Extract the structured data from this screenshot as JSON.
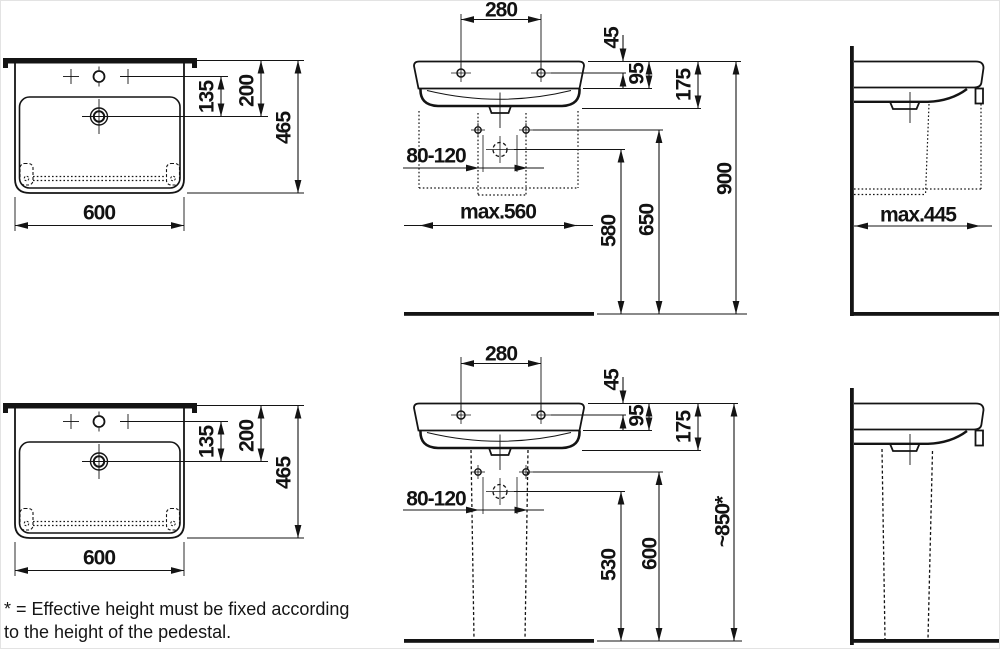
{
  "drawing_title": "washbasin-dimension-drawing",
  "colors": {
    "line": "#141414",
    "background": "#ffffff"
  },
  "dims": {
    "plan": {
      "width": "600",
      "tap": "135",
      "rear": "200",
      "depth": "465"
    },
    "front_common": {
      "taps": "280",
      "rim_tap": "45",
      "apron": "95",
      "underside": "175",
      "outlet": "80-120"
    },
    "front_wall": {
      "max_width": "max.560",
      "outlet_h": "580",
      "fixing_h": "650",
      "rim_h": "900"
    },
    "front_pedestal": {
      "outlet_h": "530",
      "fixing_h": "600",
      "rim_h": "~850*"
    },
    "side_wall": {
      "max_depth": "max.445"
    }
  },
  "footnote": {
    "line1": "* = Effective height must be fixed according",
    "line2": "to the height of the pedestal."
  }
}
